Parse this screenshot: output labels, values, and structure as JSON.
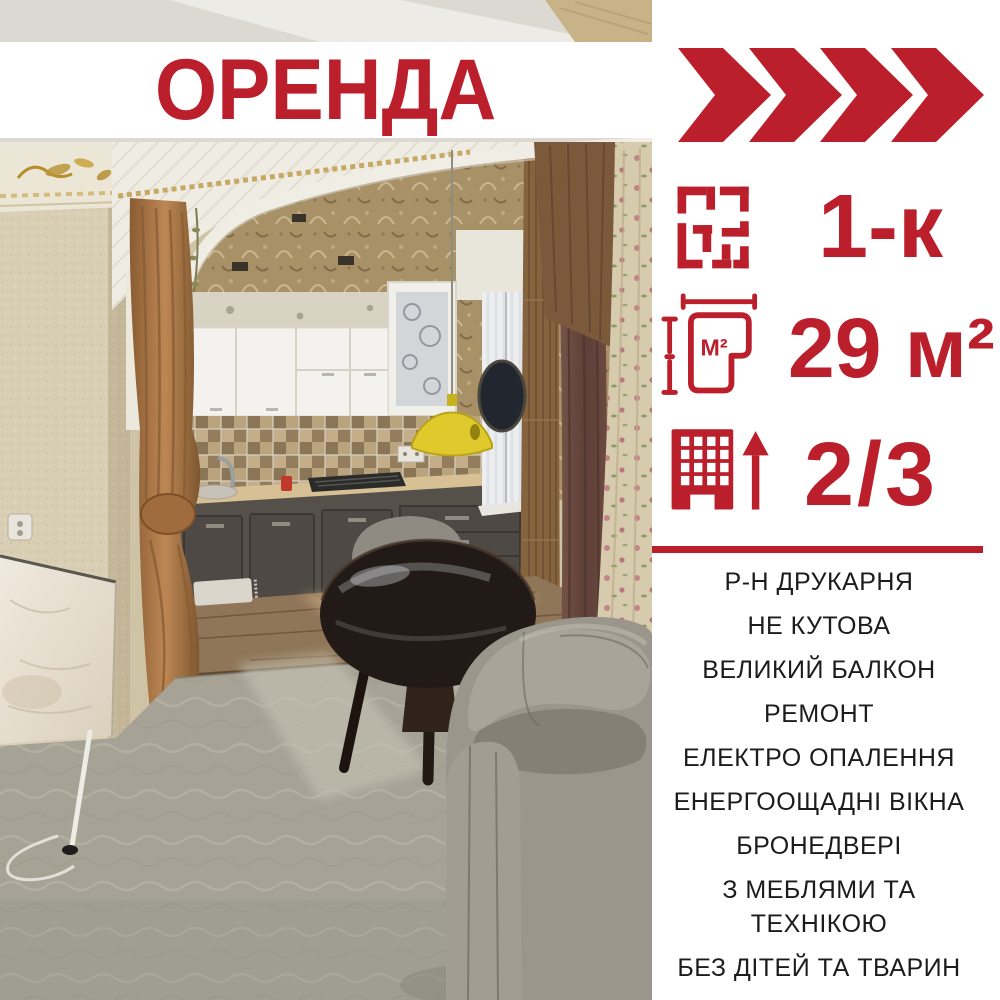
{
  "colors": {
    "accent_red": "#bc1f2c",
    "text_black": "#1c1c1c",
    "background": "#ffffff"
  },
  "title": {
    "label": "ОРЕНДА"
  },
  "badge": {
    "icon": "fast-forward-chevrons-icon",
    "chevron_count": 4
  },
  "stats": [
    {
      "icon": "floor-plan-icon",
      "value": "1-к"
    },
    {
      "icon": "area-measure-icon",
      "icon_label": "М²",
      "value": "29 м²"
    },
    {
      "icon": "building-floor-icon",
      "value": "2/3"
    }
  ],
  "features": [
    "Р-Н ДРУКАРНЯ",
    "НЕ КУТОВА",
    "ВЕЛИКИЙ БАЛКОН",
    "РЕМОНТ",
    "ЕЛЕКТРО ОПАЛЕННЯ",
    "ЕНЕРГООЩАДНІ ВІКНА",
    "БРОНЕДВЕРІ",
    "З МЕБЛЯМИ ТА\nТЕХНІКОЮ",
    "БЕЗ ДІТЕЙ ТА ТВАРИН"
  ],
  "photo": {
    "description": "Interior photo: kitchen seen through white arch with brown curtains, grey tub armchair, dark round table, panel heater, patterned carpet"
  }
}
